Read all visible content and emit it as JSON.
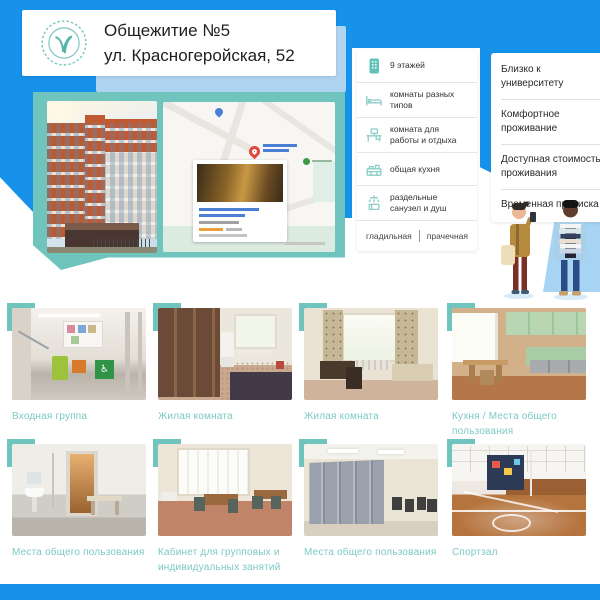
{
  "header": {
    "title_line1": "Общежитие №5",
    "title_line2": "ул. Красногеройская, 52"
  },
  "features": [
    {
      "icon": "building-icon",
      "label": "9 этажей"
    },
    {
      "icon": "bed-icon",
      "label": "комнаты разных типов"
    },
    {
      "icon": "workroom-icon",
      "label": "комната для работы и отдыха"
    },
    {
      "icon": "kitchen-icon",
      "label": "общая кухня"
    },
    {
      "icon": "shower-icon",
      "label": "раздельные санузел и душ"
    }
  ],
  "laundry": {
    "left": "гладильная",
    "right": "прачечная"
  },
  "benefits": [
    {
      "label": "Близко к университету"
    },
    {
      "label": "Комфортное проживание"
    },
    {
      "label": "Доступная стоимость проживания"
    },
    {
      "label": "Временная прописка"
    }
  ],
  "gallery": [
    {
      "caption": "Входная группа"
    },
    {
      "caption": "Жилая комната"
    },
    {
      "caption": "Жилая комната"
    },
    {
      "caption": "Кухня / Места общего пользования"
    },
    {
      "caption": "Места общего пользования"
    },
    {
      "caption": "Кабинет для групповых и индивидуальных занятий"
    },
    {
      "caption": "Места общего пользования"
    },
    {
      "caption": "Спортзал"
    }
  ],
  "colors": {
    "accent_blue": "#1792EB",
    "accent_teal": "#6FC4BD",
    "caption_teal": "#7CCAC3"
  }
}
